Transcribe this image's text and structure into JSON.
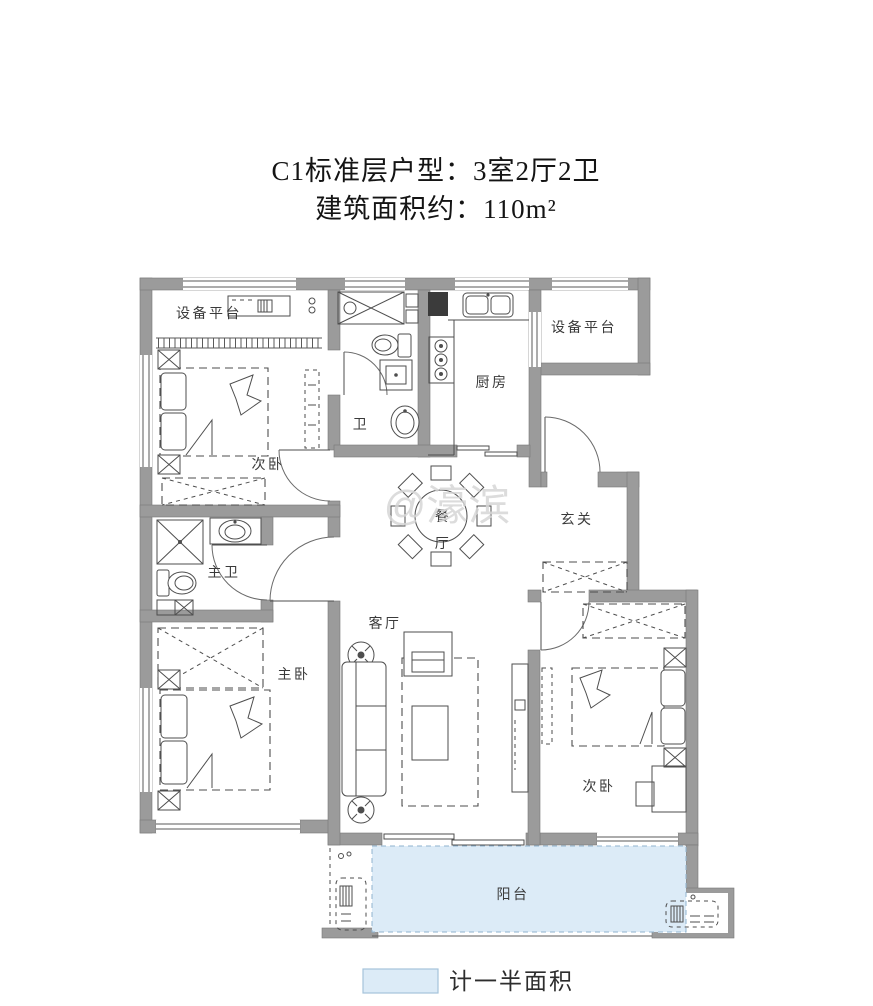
{
  "title": {
    "line1": "C1标准层户型：3室2厅2卫",
    "line2": "建筑面积约：110m²"
  },
  "watermark": "@濠滨",
  "rooms": {
    "equipment_platform_left": "设备平台",
    "equipment_platform_right": "设备平台",
    "bedroom_top_left": "次卧",
    "bathroom": "卫",
    "kitchen": "厨房",
    "foyer": "玄关",
    "dining_char_top": "餐",
    "dining_char_bottom": "厅",
    "master_bathroom": "主卫",
    "master_bedroom": "主卧",
    "living_room": "客厅",
    "bedroom_bottom_right": "次卧",
    "balcony": "阳台"
  },
  "legend": {
    "label": "计一半面积"
  },
  "colors": {
    "wall": "#9b9b9b",
    "line": "#4e4e4e",
    "balcony_fill": "#dcebf7",
    "balcony_border": "#8fb3cf",
    "watermark": "#d6d6d6"
  }
}
